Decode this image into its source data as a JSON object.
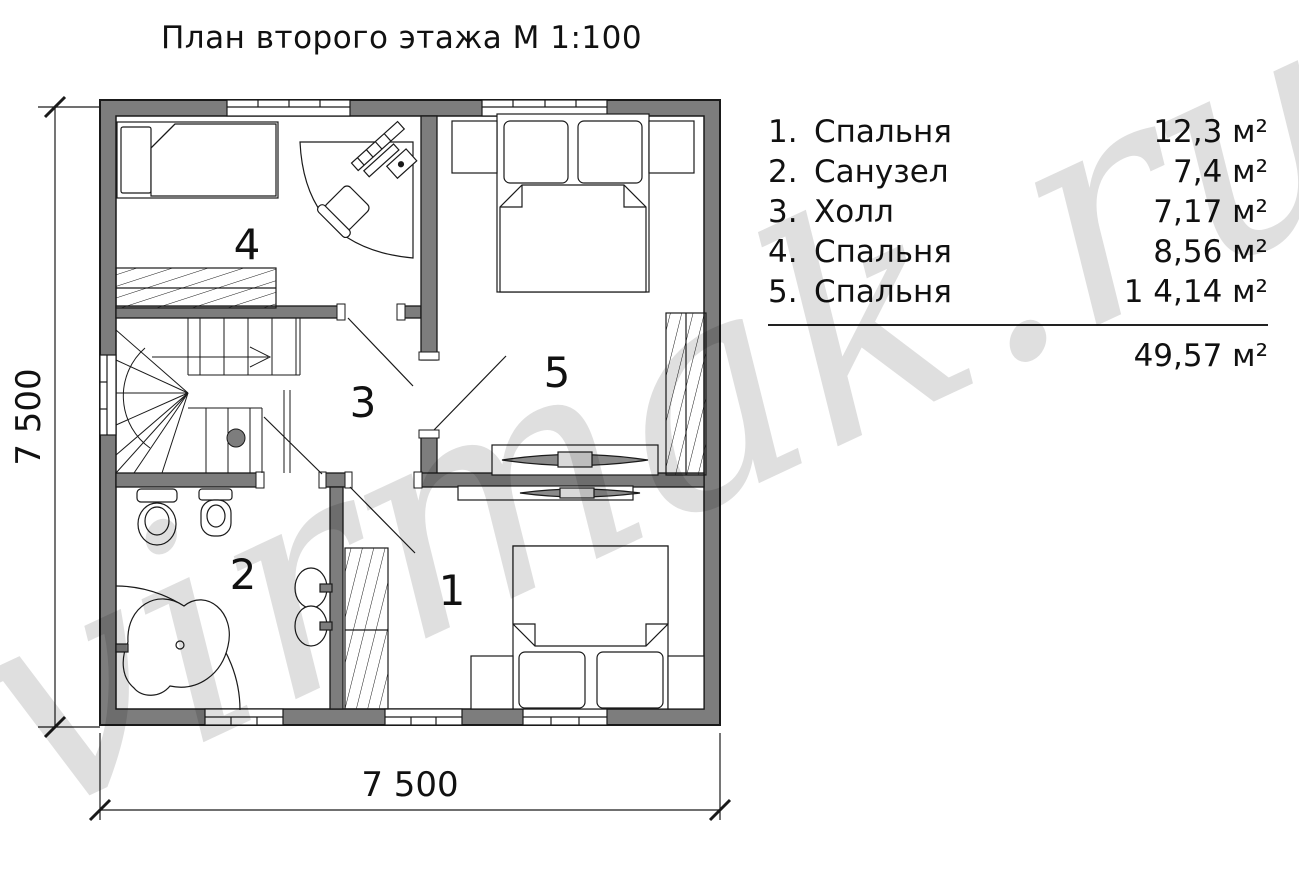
{
  "title": "План второго этажа М 1:100",
  "watermark": "virmak.ru",
  "legend": {
    "rows": [
      {
        "num": "1.",
        "name": "Спальня",
        "area": "12,3 м²"
      },
      {
        "num": "2.",
        "name": "Санузел",
        "area": "7,4 м²"
      },
      {
        "num": "3.",
        "name": "Холл",
        "area": "7,17 м²"
      },
      {
        "num": "4.",
        "name": "Спальня",
        "area": "8,56 м²"
      },
      {
        "num": "5.",
        "name": "Спальня",
        "area": "1 4,14 м²"
      }
    ],
    "total_area": "49,57 м²"
  },
  "dimensions": {
    "horizontal": "7 500",
    "vertical": "7 500"
  },
  "room_labels": {
    "r1": "1",
    "r2": "2",
    "r3": "3",
    "r4": "4",
    "r5": "5"
  },
  "colors": {
    "wall_fill": "#7d7d7d",
    "line": "#1a1a1a",
    "watermark_gray": "#dedede",
    "background": "#ffffff"
  }
}
